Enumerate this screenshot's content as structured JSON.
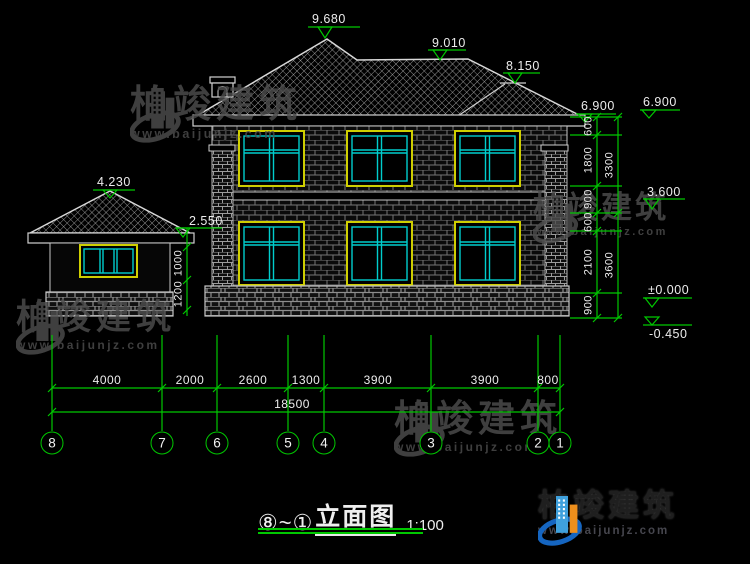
{
  "title": {
    "prefix": "⑧~①",
    "name": "立面图",
    "scale": "1:100"
  },
  "markers": {
    "peak": "9.680",
    "ridge": "9.010",
    "ridge2": "8.150",
    "eave": "6.900",
    "eave_ref": "6.900",
    "floor2": "3.600",
    "zero": "±0.000",
    "minus": "-0.450",
    "g_peak": "4.230",
    "g_eave": "2.550"
  },
  "dims": {
    "right_inner": [
      "600",
      "1800",
      "900",
      "600",
      "2100",
      "900"
    ],
    "right_outer": [
      "3300",
      "3600"
    ],
    "left": [
      "1000",
      "1200"
    ],
    "bottom": [
      "4000",
      "2000",
      "2600",
      "1300",
      "3900",
      "3900",
      "800"
    ],
    "total": "18500"
  },
  "axes": [
    "8",
    "7",
    "6",
    "5",
    "4",
    "3",
    "2",
    "1"
  ],
  "watermark": {
    "title": "柏竣建筑",
    "url": "www.baijunjz.com"
  },
  "logo": {
    "title": "柏竣建筑",
    "url": "www.baijunjz.com"
  },
  "colors": {
    "dim_green": "#00c800",
    "window_frame_yellow": "#cfcf00",
    "window_pane_cyan": "#00cdcd",
    "line_white": "#d8d8d8",
    "watermark_gray": "#4d4d4d",
    "logo_blue": "#1565c0",
    "logo_light_blue": "#3fa0dc",
    "logo_orange": "#ee8f1c"
  }
}
